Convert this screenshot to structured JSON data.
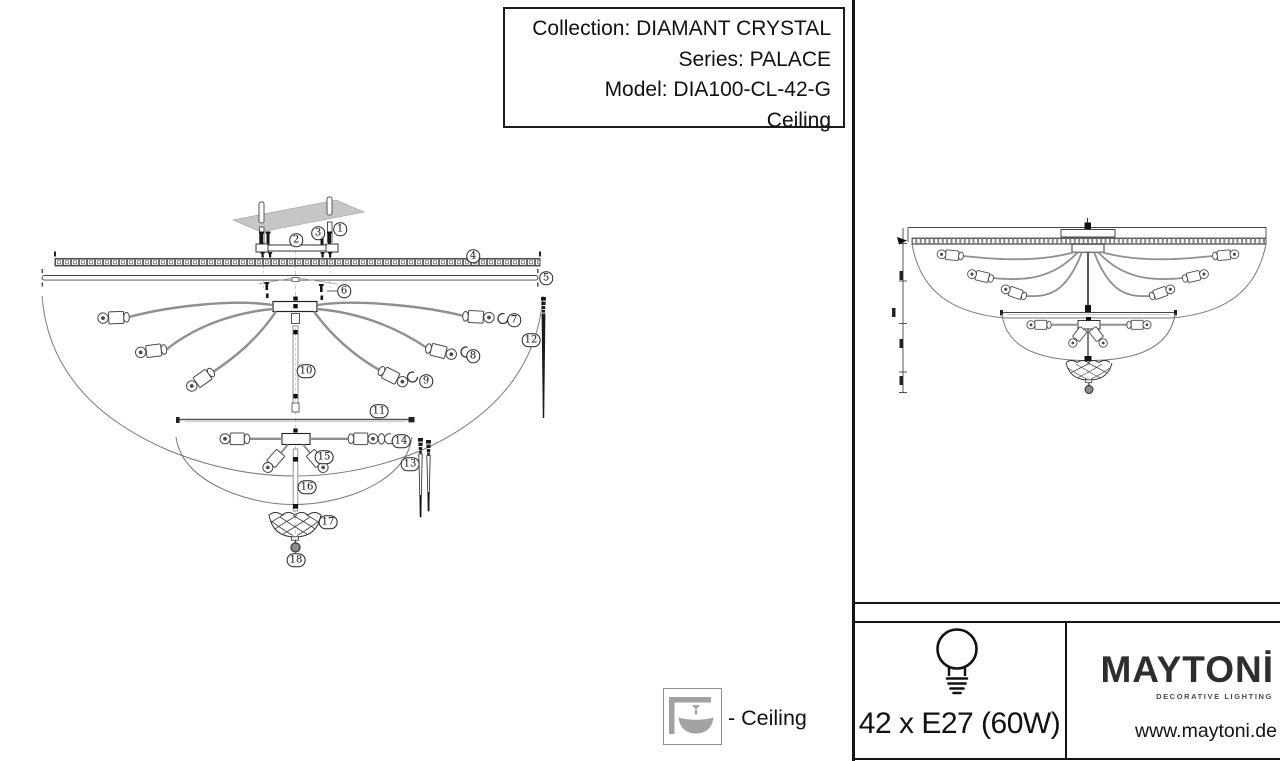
{
  "title_box": {
    "collection": "Collection: DIAMANT CRYSTAL",
    "series": "Series: PALACE",
    "model": "Model: DIA100-CL-42-G",
    "mount_type": "Ceiling"
  },
  "legend": {
    "ceiling_label": "- Ceiling"
  },
  "spec": {
    "bulbs_label": "42 x E27 (60W)"
  },
  "brand": {
    "logo": "MAYTONİ",
    "tagline": "DECORATIVE LIGHTING",
    "website": "www.maytoni.de"
  },
  "icons": {
    "bulb": "bulb-icon",
    "ceiling_mount": "ceiling-mount-icon"
  },
  "colors": {
    "line": "#151515",
    "diagram_gray": "#909090",
    "plate_gray": "#c6c6c6",
    "icon_gray": "#a2a2a2",
    "background": "#ffffff"
  },
  "diagram": {
    "parts": [
      {
        "n": "1",
        "x": 340,
        "y": 229
      },
      {
        "n": "2",
        "x": 296,
        "y": 240
      },
      {
        "n": "3",
        "x": 318,
        "y": 233
      },
      {
        "n": "4",
        "x": 473,
        "y": 256
      },
      {
        "n": "5",
        "x": 546,
        "y": 278
      },
      {
        "n": "6",
        "x": 344,
        "y": 291
      },
      {
        "n": "7",
        "x": 514,
        "y": 320
      },
      {
        "n": "8",
        "x": 473,
        "y": 356
      },
      {
        "n": "9",
        "x": 426,
        "y": 381
      },
      {
        "n": "10",
        "x": 306,
        "y": 371
      },
      {
        "n": "11",
        "x": 379,
        "y": 411
      },
      {
        "n": "12",
        "x": 531,
        "y": 340
      },
      {
        "n": "13",
        "x": 410,
        "y": 464
      },
      {
        "n": "14",
        "x": 401,
        "y": 441
      },
      {
        "n": "15",
        "x": 324,
        "y": 457
      },
      {
        "n": "16",
        "x": 307,
        "y": 487
      },
      {
        "n": "17",
        "x": 328,
        "y": 522
      },
      {
        "n": "18",
        "x": 296,
        "y": 560
      }
    ]
  }
}
